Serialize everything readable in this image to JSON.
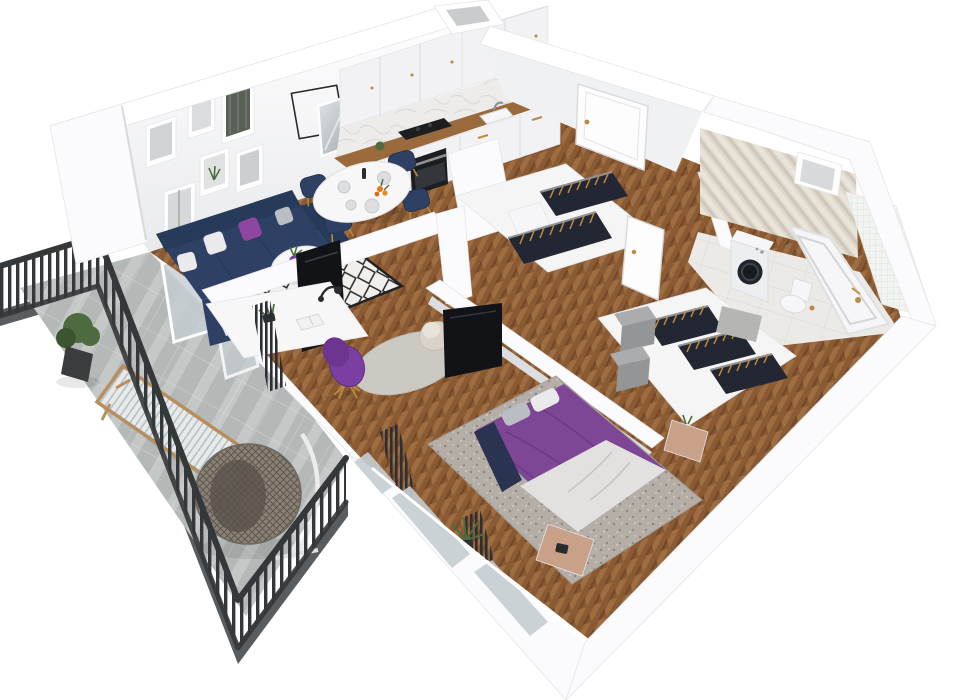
{
  "canvas": {
    "width": 961,
    "height": 700
  },
  "scene": {
    "view": "isometric-cutaway-floor-plan-render",
    "rooms": [
      {
        "name": "living-room",
        "items": [
          "corner-sofa-navy",
          "throw-pillows",
          "coffee-table-round",
          "diamond-pattern-rug",
          "gallery-wall-frames",
          "wire-square-frame",
          "wall-mirror",
          "tv-panel",
          "sliding-glass-door"
        ]
      },
      {
        "name": "dining-area",
        "items": [
          "round-white-table",
          "navy-dining-chairs-gold-legs",
          "plates",
          "orange-flowers",
          "candlestick"
        ]
      },
      {
        "name": "kitchen",
        "items": [
          "white-upper-cabinets",
          "marble-backsplash",
          "wood-countertop",
          "black-cooktop",
          "built-in-oven",
          "sink-with-faucet",
          "ventilation-shaft"
        ]
      },
      {
        "name": "entrance-hall",
        "items": [
          "entrance-door",
          "open-top-wardrobe",
          "hanging-clothes",
          "drawer-chest"
        ]
      },
      {
        "name": "home-office-nook",
        "items": [
          "white-desk",
          "desk-lamp",
          "open-book",
          "desk-plant",
          "purple-swivel-chair",
          "beige-armchair",
          "round-gray-rug",
          "radiator"
        ]
      },
      {
        "name": "bedroom",
        "items": [
          "double-bed-purple-bedding",
          "white-duvet",
          "pillows",
          "mottled-gray-rug",
          "wood-nightstand",
          "wood-bench",
          "wardrobe-with-clothes",
          "gray-storage-boxes",
          "wall-tv",
          "radiators",
          "palm-plant",
          "windows"
        ]
      },
      {
        "name": "bathroom",
        "items": [
          "herringbone-tile-wall",
          "mosaic-half-wall",
          "bathtub",
          "brass-faucet",
          "washing-machine",
          "wall-hung-toilet",
          "bath-mat",
          "wall-niche",
          "bathroom-door"
        ]
      },
      {
        "name": "balcony",
        "items": [
          "dark-metal-railing",
          "concrete-tile-floor",
          "hanging-egg-chair",
          "wooden-lounger",
          "potted-plant",
          "leaning-glass-panels"
        ]
      }
    ]
  },
  "palette": {
    "wall_white": "#fbfbfd",
    "wall_top": "#ffffff",
    "wall_grad_top": "#fdfdfe",
    "wall_grad_bottom": "#e9eaec",
    "wall_face_ne": "#f0f1f3",
    "wall_stroke": "#e4e5e8",
    "floor_wood": "#8a5a33",
    "floor_wood_light": "#9e6e42",
    "floor_wood_dark": "#74492a",
    "balcony_floor": "#b4b9b7",
    "balcony_grout": "#c7cbc9",
    "sun_stripe": "#ffffff",
    "slab_edge": "#595d5f",
    "fence_dark": "#35383b",
    "glass": "#c5cdd2",
    "sofa_navy": "#2e4165",
    "sofa_dark": "#263a59",
    "pillow_purple": "#8f46a0",
    "pillow_gray": "#b9bdc4",
    "pillow_white": "#eaeaec",
    "rug_white": "#f0efed",
    "rug_black": "#232323",
    "bed_purple": "#7d4795",
    "bed_purple_dark": "#68387f",
    "duvet_white": "#e3e1e0",
    "throw_navy": "#2a3350",
    "rug_bedroom": "#b4aea6",
    "rug_speckle": "#8d877f",
    "nightstand_wood": "#c9a189",
    "closet_white": "#f5f5f6",
    "clothes_dark": "#232733",
    "hanger_gold": "#c08a3e",
    "box_gray_light": "#aaacae",
    "box_gray_dark": "#939597",
    "tv_black": "#121316",
    "chair_purple": "#7a3fa0",
    "desk_white": "#f7f7f8",
    "lamp_black": "#2a2b2e",
    "counter_wood": "#9a6a3c",
    "cabinet_white": "#f2f2f4",
    "marble": "#edecea",
    "marble_vein": "#d9d9d7",
    "appliance_black": "#1d1e20",
    "steel": "#8e9296",
    "knob_gold": "#b9893f",
    "door_white": "#fdfdfe",
    "tile_wall": "#ded8cc",
    "tile_wall_light": "#e9e4d9",
    "tile_wall_dark": "#cfc8ba",
    "mosaic": "#f2f4f1",
    "mosaic_line": "#dfe3df",
    "bath_floor": "#ebeae6",
    "bath_tile_line": "#dcdbd7",
    "mat_gray": "#b5b6b4",
    "brass": "#b98a4a",
    "washer_door": "#20242c",
    "white_goods": "#f6f6f8",
    "plant_green": "#4e6b3f",
    "plant_dark": "#3a5530",
    "rattan": "#8a8074",
    "rattan_dark": "#5a534b",
    "lounger_wood": "#b98e5f",
    "cushion": "#e9e9e7",
    "cushion_stripe": "#a9bcc9",
    "radiator_dark": "#2c2f33"
  }
}
